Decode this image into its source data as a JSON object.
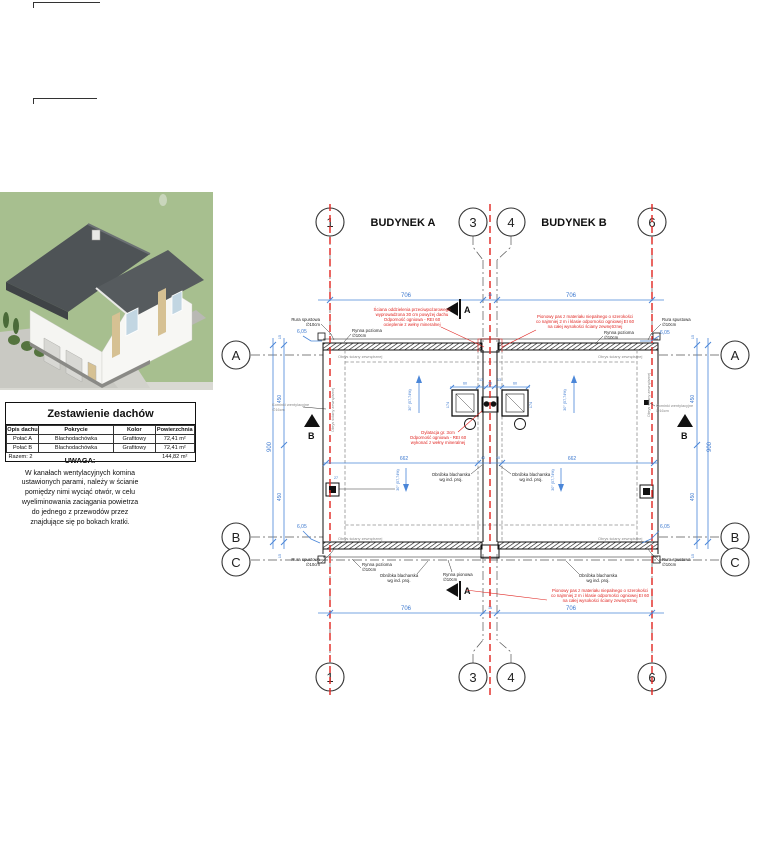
{
  "roof_table": {
    "title": "Zestawienie dachów",
    "columns": [
      "Opis dachu",
      "Pokrycie",
      "Kolor",
      "Powierzchnia"
    ],
    "rows": [
      [
        "Połać A",
        "Blachodachówka",
        "Grafitowy",
        "72,41 m²"
      ],
      [
        "Połać B",
        "Blachodachówka",
        "Grafitowy",
        "72,41 m²"
      ]
    ],
    "total_label": "Razem: 2",
    "total_value": "144,82 m²"
  },
  "note": {
    "title": "UWAGA:",
    "lines": [
      "W kanałach wentylacyjnych komina",
      "ustawionych parami, należy w ścianie",
      "pomiędzy nimi wyciąć otwór, w celu",
      "wyeliminowania zaciągania powietrza",
      "do jednego z przewodów przez",
      "znajdujące się po bokach kratki."
    ]
  },
  "plan": {
    "building_a": "BUDYNEK A",
    "building_b": "BUDYNEK B",
    "axes": {
      "n1": "1",
      "n3": "3",
      "n4": "4",
      "n6": "6",
      "la": "A",
      "lb": "B",
      "lc": "C"
    },
    "sections": {
      "sa": "A",
      "sb": "B"
    },
    "dims": {
      "span": "706",
      "gap": "16",
      "total": "900",
      "half": "450",
      "edge": "15",
      "mid": "662",
      "mid_small": "40",
      "eave": "6,05",
      "vent": "27",
      "chim_h": "174",
      "c60": "60",
      "c13": "13",
      "c26": "26",
      "slope": "30° (57,74%)"
    },
    "red": {
      "firewall": [
        "Ściana oddzielenia przeciwpożarowego",
        "wyprowadzona 30 cm powyżej dachu",
        "Odporność ogniowa - REI 60",
        "ocieplenie z wełny mineralnej"
      ],
      "strip": [
        "Pionowy pas z materiału niepalnego o szerokości",
        "co najmniej 2 m i klasie odporności ogniowej EI 60",
        "na całej wysokości ściany zewnętrznej"
      ],
      "dylatacja": [
        "Dylatacja gr. 3cm",
        "Odporność ogniowa - REI 60",
        "wykonać z wełny mineralnej"
      ]
    },
    "labels": {
      "rura": [
        "Rura spustowa",
        "∅10cm"
      ],
      "rynna_pozioma": [
        "Rynna pozioma",
        "∅10cm"
      ],
      "rynna_pionowa": [
        "Rynna pionowa",
        "∅10cm"
      ],
      "obrobka": [
        "Obróbka blacharska",
        "wg ind. proj."
      ],
      "obrys": "Obrys ściany zewnętrznej",
      "kominki": [
        "Kominki wentylacyjne",
        "∅16cm"
      ]
    },
    "colors": {
      "dim_blue": "#4a86d8",
      "annot_red": "#e02420",
      "grid_gray": "#555555"
    }
  },
  "view3d": {
    "colors": {
      "grass": "#a7bf8f",
      "roof": "#4e5356",
      "roof2": "#565b5e",
      "wall": "#f5f5f2",
      "accent": "#d6c193",
      "glass": "#c2d6e2",
      "paving": "#c9c9c3",
      "bush": "#55743f"
    }
  }
}
